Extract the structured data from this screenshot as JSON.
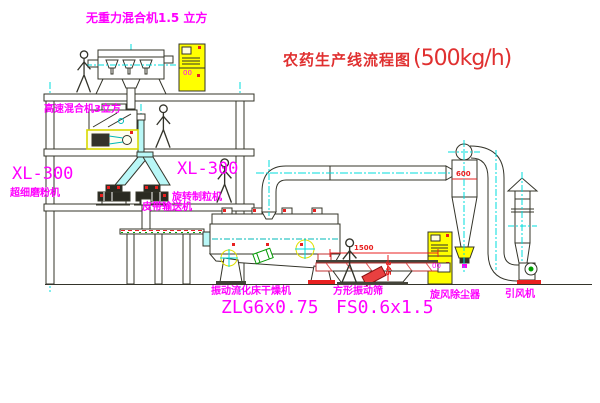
{
  "title": {
    "name": "农药生产线流程图",
    "capacity": "(500kg/h)"
  },
  "labels": {
    "gravity_mixer": "无重力混合机1.5 立方",
    "high_speed_mixer": "高速混合机3立方",
    "mill_model": "XL-300",
    "mill_name": "超细磨粉机",
    "granulator_model": "XL-300",
    "granulator_name": "旋转制粒机",
    "belt_conveyor": "皮带输送机",
    "dryer_name": "振动流化床干燥机",
    "dryer_model": "ZLG6x0.75",
    "screen_name": "方形振动筛",
    "screen_model": "FS0.6x1.5",
    "cyclone_name": "旋风除尘器",
    "fan_name": "引风机",
    "cabinet_marker": "00"
  },
  "dimensions": {
    "screen_length": "1500",
    "screen_height": "345",
    "cyclone_diameter": "600"
  },
  "colors": {
    "annotation_magenta": "#ff00ff",
    "title_red": "#e03030",
    "centerline_cyan": "#00dcdc",
    "cabinet_yellow": "#ffff00",
    "dimension_red": "#e82020",
    "drawing_line": "#34342a",
    "motor_green": "#00a000"
  }
}
